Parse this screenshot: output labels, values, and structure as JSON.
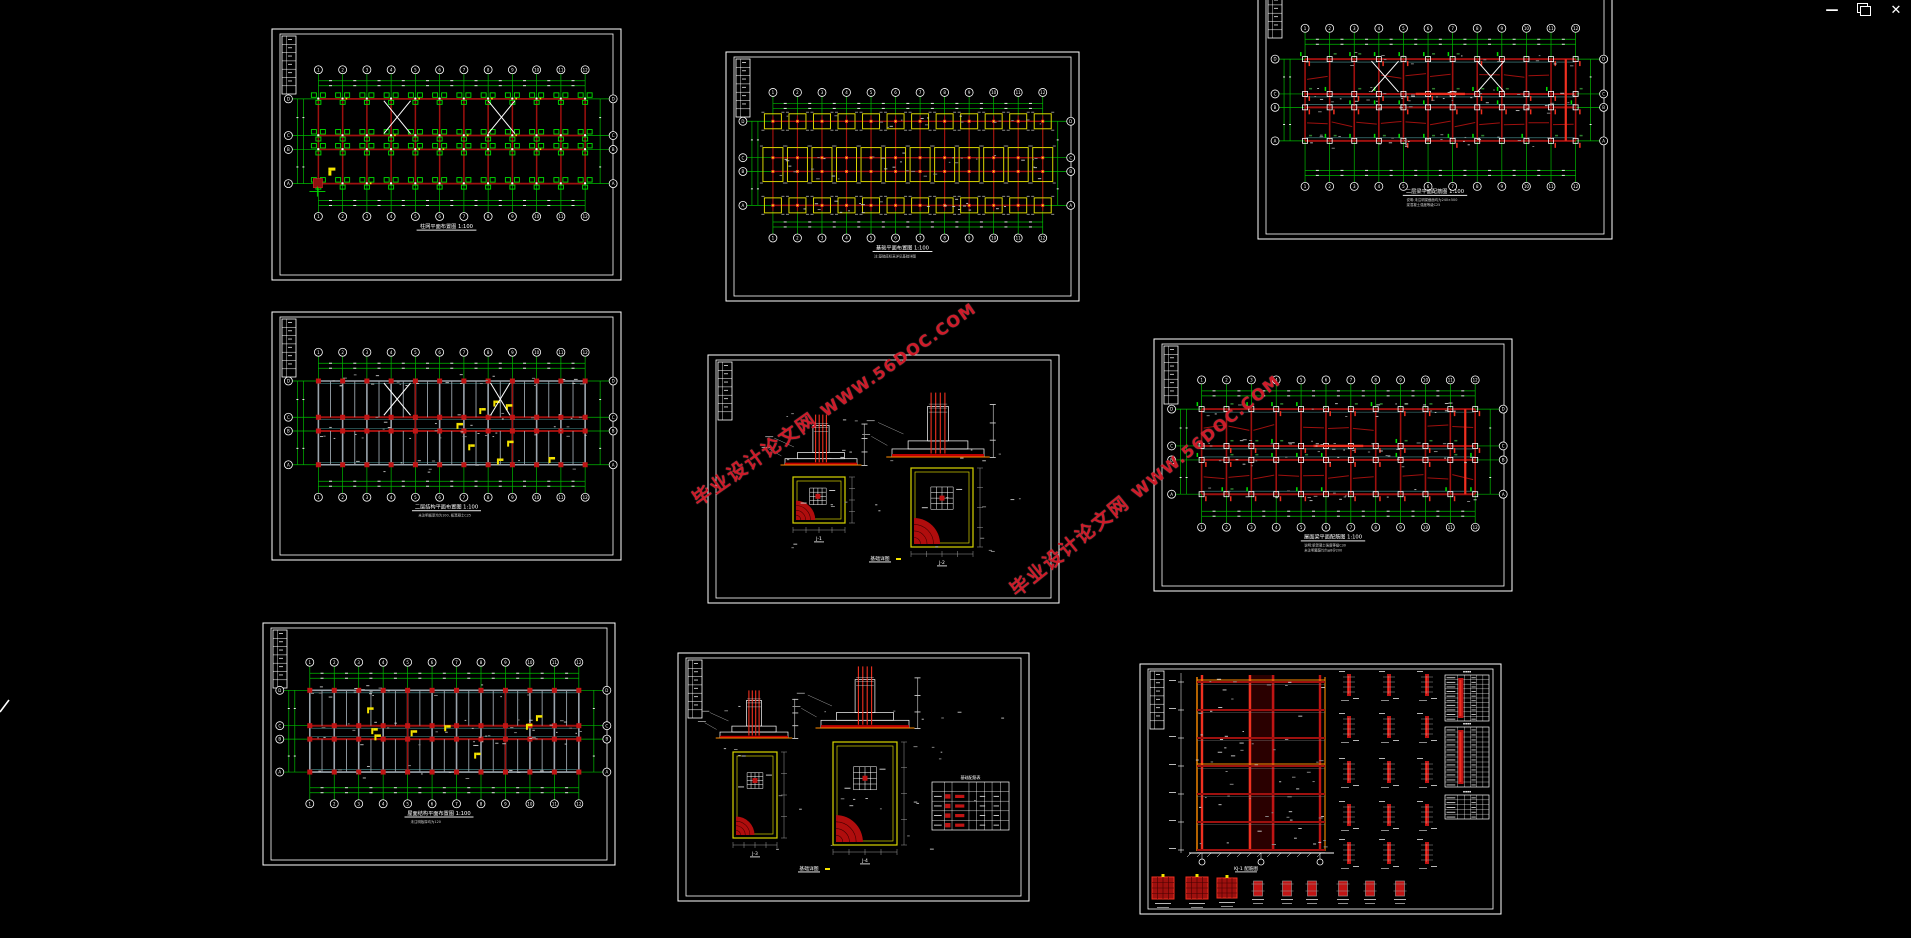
{
  "window": {
    "controls": {
      "minimize_label": "—",
      "restore_icon": "restore-window-icon",
      "close_label": "✕"
    }
  },
  "canvas": {
    "background": "#000000"
  },
  "watermark": {
    "text_cn": "毕业设计论文网",
    "text_url": "WWW.56DOC.COM",
    "color": "#ce1b29",
    "instances": [
      {
        "x": 694,
        "y": 487,
        "angle": -35
      },
      {
        "x": 1012,
        "y": 578,
        "angle": -39
      }
    ]
  },
  "axes": {
    "columns": [
      "1",
      "2",
      "3",
      "4",
      "5",
      "6",
      "7",
      "8",
      "9",
      "10",
      "11",
      "12"
    ],
    "rows": [
      "D",
      "C",
      "B",
      "A"
    ]
  },
  "colors": {
    "axis_green": "#00b800",
    "bright_green": "#00e000",
    "beam_dark_red": "#9e100e",
    "column_red": "#c01414",
    "bright_red": "#f03020",
    "footing_yellow": "#d8d400",
    "annotation_yellow": "#f5e400",
    "orange": "#ff8c00",
    "steel_gray": "#9aa4ac",
    "cyan_beam": "#4c9898",
    "dim_gray": "#9c9c9c",
    "white": "#ffffff"
  },
  "sheets": [
    {
      "id": "top-left",
      "type": "grid-plan",
      "variant": "column-plan",
      "x": 271,
      "y": 28,
      "w": 351,
      "h": 253,
      "title": "柱网平面布置图 1:100",
      "notes": [],
      "braces": [
        [
          2.7,
          3.8
        ],
        [
          7.0,
          8.1
        ]
      ],
      "accent": true
    },
    {
      "id": "top-middle",
      "type": "grid-plan",
      "variant": "foundation",
      "x": 725,
      "y": 51,
      "w": 355,
      "h": 251,
      "title": "基础平面布置图 1:100",
      "notes": [
        "注:基础底标高详见基础详图"
      ],
      "braces": []
    },
    {
      "id": "top-right",
      "type": "grid-plan",
      "variant": "beam-plan",
      "x": 1257,
      "y": -28,
      "w": 356,
      "h": 268,
      "title": "二层梁平面配筋图 1:100",
      "notes": [
        "说明:未注明梁截面均为240×500",
        "梁混凝土强度等级C25"
      ],
      "braces": [
        [
          2.7,
          3.8
        ],
        [
          7.0,
          8.1
        ]
      ],
      "hot": [
        10.6
      ],
      "fr": {
        "yT": 0.21,
        "r0": 0.325,
        "r1": 0.455,
        "r2": 0.505,
        "r3": 0.63,
        "yB": 0.8,
        "ti": 0.825
      }
    },
    {
      "id": "mid-left",
      "type": "grid-plan",
      "variant": "floor-plan",
      "x": 271,
      "y": 311,
      "w": 351,
      "h": 250,
      "title": "二层结构平面布置图 1:100",
      "notes": [
        "未注明板厚均为100, 板混凝土C25"
      ],
      "braces": [
        [
          2.7,
          3.8
        ],
        [
          7.1,
          7.9
        ]
      ]
    },
    {
      "id": "mid-middle",
      "type": "footing-detail",
      "x": 707,
      "y": 354,
      "w": 353,
      "h": 250,
      "title": "基础详图",
      "labels": [
        "J-1",
        "J-2"
      ]
    },
    {
      "id": "mid-right",
      "type": "grid-plan",
      "variant": "beam-plan",
      "x": 1153,
      "y": 338,
      "w": 360,
      "h": 254,
      "title": "屋面梁平面配筋图 1:100",
      "notes": [
        "说明:梁混凝土强度等级C30",
        "未注明箍筋均为φ8@200"
      ],
      "braces": [],
      "hot": [
        10.6
      ]
    },
    {
      "id": "bottom-left",
      "type": "grid-plan",
      "variant": "floor-plan",
      "x": 262,
      "y": 622,
      "w": 354,
      "h": 244,
      "title": "屋面结构平面布置图 1:100",
      "notes": [
        "未注明板厚均为120"
      ],
      "braces": []
    },
    {
      "id": "bottom-middle",
      "type": "footing-detail",
      "x": 677,
      "y": 652,
      "w": 353,
      "h": 250,
      "title": "基础详图",
      "labels": [
        "J-3",
        "J-4"
      ],
      "table": {
        "title": "基础配筋表",
        "rows": [
          "J-1",
          "J-2",
          "J-3",
          "J-4"
        ]
      }
    },
    {
      "id": "bottom-right",
      "type": "frame-elevation",
      "x": 1139,
      "y": 663,
      "w": 363,
      "h": 252,
      "title": "KJ-1 配筋图",
      "tables": [
        "柱配筋表",
        "柱配筋表",
        "梁配筋表"
      ]
    }
  ]
}
